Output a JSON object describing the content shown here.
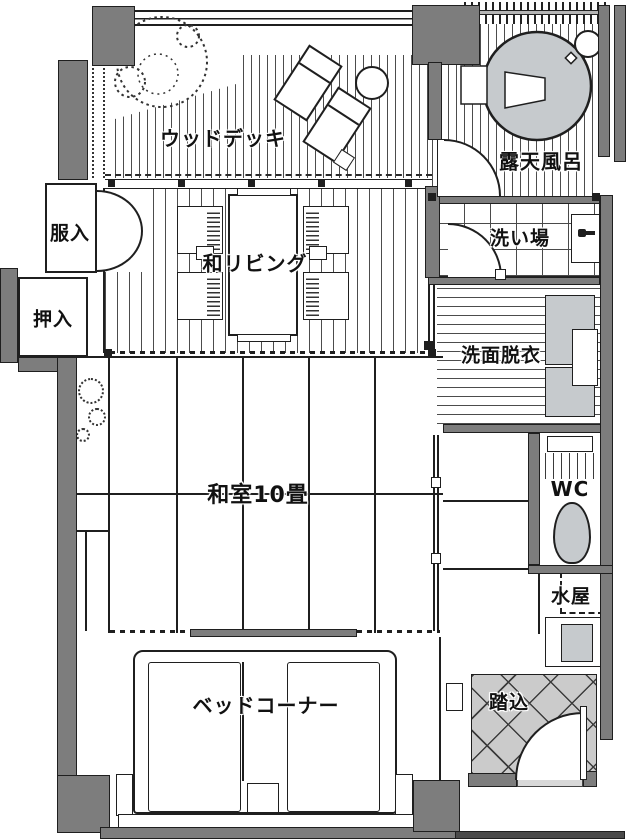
{
  "rooms": {
    "wood_deck": {
      "label": "ウッドデッキ"
    },
    "open_air_bath": {
      "label": "露天風呂"
    },
    "clothes_closet": {
      "label": "服入"
    },
    "futon_closet": {
      "label": "押入"
    },
    "japanese_living": {
      "label": "和リビング"
    },
    "washing_area": {
      "label": "洗い場"
    },
    "washroom_dressing": {
      "label": "洗面脱衣"
    },
    "tatami_room": {
      "label": "和室10畳"
    },
    "toilet": {
      "label": "WC"
    },
    "mizuya": {
      "label": "水屋"
    },
    "bed_corner": {
      "label": "ベッドコーナー"
    },
    "entrance_step": {
      "label": "踏込"
    }
  },
  "colors": {
    "wall_gray": "#7d7d7d",
    "fixture_gray": "#c6cacd",
    "entrance_tile_gray": "#cbcbcb",
    "porch_dark_gray": "#4a4a4a",
    "outline_black": "#1f1f1f",
    "floor_white": "#ffffff"
  }
}
